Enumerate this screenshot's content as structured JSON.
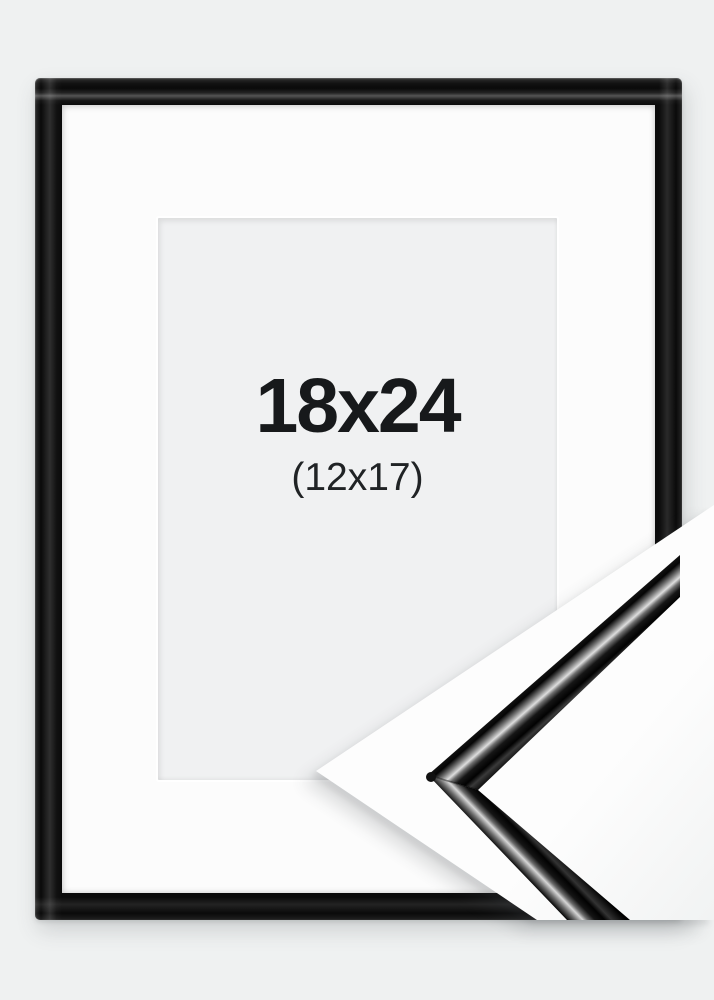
{
  "page": {
    "background_color": "#eff1f1"
  },
  "frame_product": {
    "size_label": "18x24",
    "matted_size_label": "(12x17)",
    "frame_color": "#0a0a0a",
    "mat_color": "#fcfcfc",
    "aperture_color": "#f0f1f2",
    "text_color": "#17191b"
  }
}
